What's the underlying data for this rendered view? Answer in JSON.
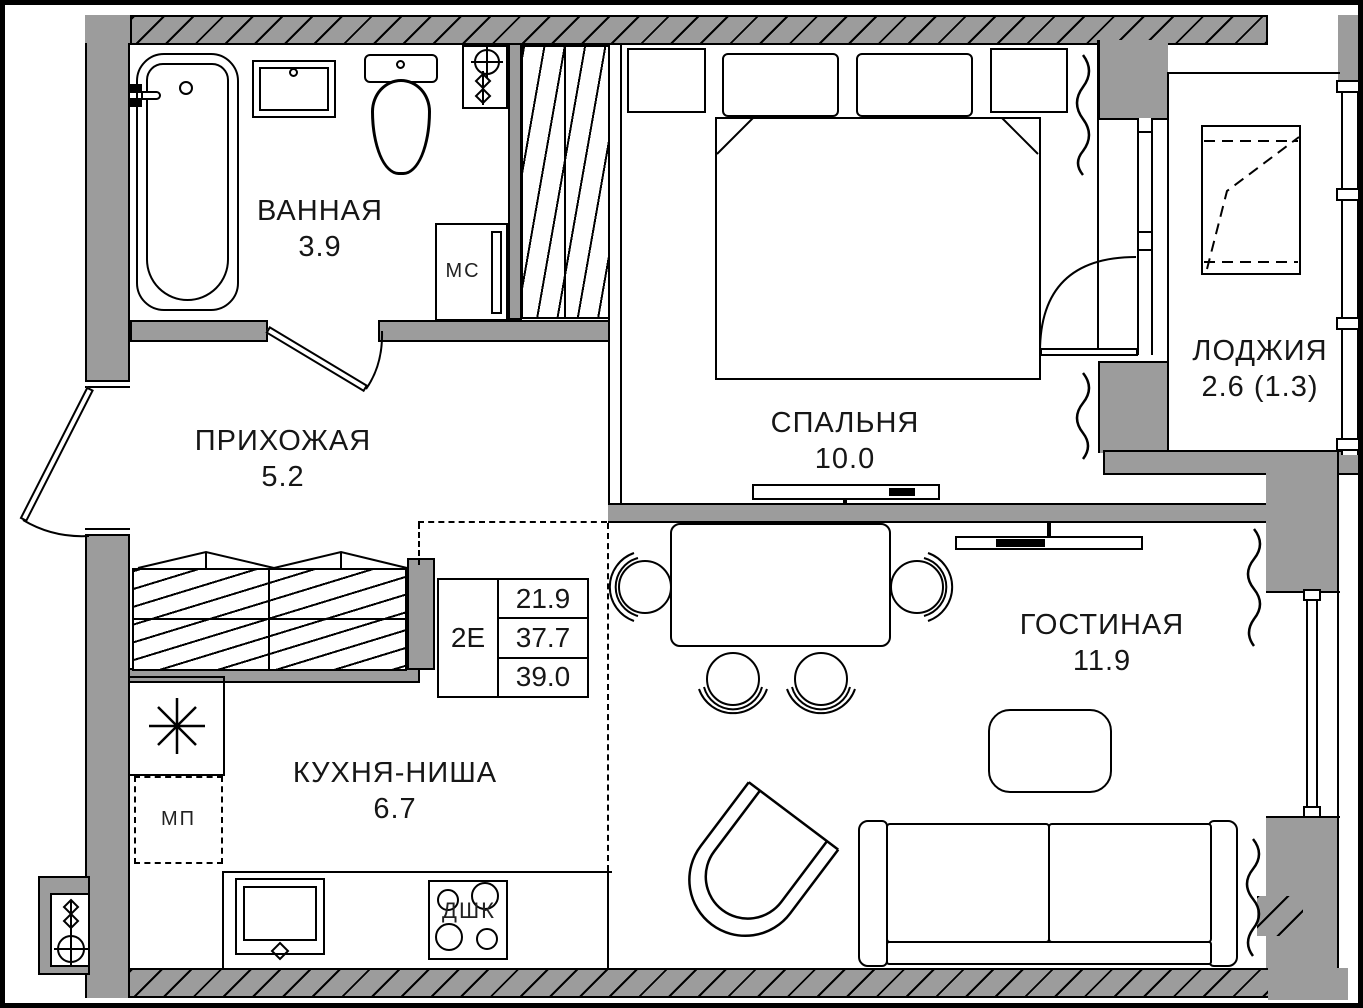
{
  "rooms": [
    {
      "key": "bathroom",
      "name": "ВАННАЯ",
      "area": "3.9"
    },
    {
      "key": "hallway",
      "name": "ПРИХОЖАЯ",
      "area": "5.2"
    },
    {
      "key": "bedroom",
      "name": "СПАЛЬНЯ",
      "area": "10.0"
    },
    {
      "key": "loggia",
      "name": "ЛОДЖИЯ",
      "area": "2.6 (1.3)"
    },
    {
      "key": "living_room",
      "name": "ГОСТИНАЯ",
      "area": "11.9"
    },
    {
      "key": "kitchen_niche",
      "name": "КУХНЯ-НИША",
      "area": "6.7"
    }
  ],
  "info_table": {
    "unit_type": "2Е",
    "values": [
      "21.9",
      "37.7",
      "39.0"
    ]
  },
  "appliances": {
    "mc": "МС",
    "mp": "МП",
    "dshk": "ДШК"
  },
  "colors": {
    "wall": "#9c9c9c",
    "line": "#000000",
    "background": "#ffffff"
  }
}
